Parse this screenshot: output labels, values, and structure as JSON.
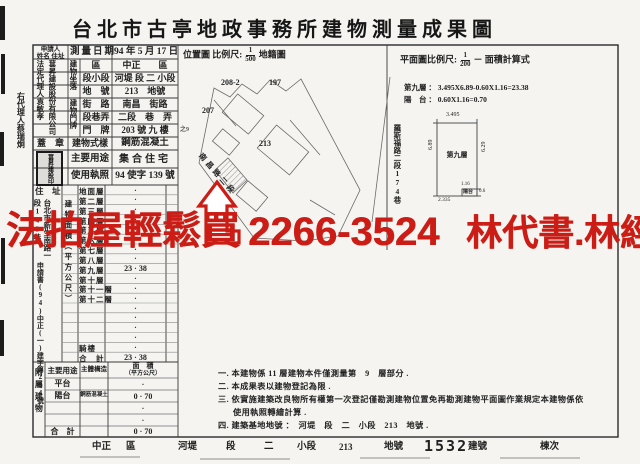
{
  "title": "台北市古亭地政事務所建物測量成果圖",
  "colors": {
    "accent_red": "#cb1d15",
    "ink": "#222222"
  },
  "watermark": {
    "left": "法拍屋輕鬆買",
    "phone": "2266-3524",
    "right": "林代書.林經理"
  },
  "header": {
    "survey_date_label": "測量日期",
    "survey_date": "94 年 5 月 17 日",
    "location_map_label": "位置圖 比例尺:",
    "location_scale_num": "1",
    "location_scale_den": "500",
    "location_map_suffix": "地籍圖",
    "plan_scale_label": "平面圖比例尺:",
    "plan_scale_num": "1",
    "plan_scale_den": "200",
    "plan_scale_suffix": "－ 面積計算式"
  },
  "applicant": {
    "header_line1": "申請人",
    "header_line2": "姓名 住址",
    "company": "葚昇建設股份有限公司",
    "legal_rep": "法定代理人袁敏孝",
    "agent_outside": "右代理人蔡瑞炯",
    "seal_label": "蓋　章",
    "seal_text": "葚昇建設印",
    "address_label": "住　址",
    "address_col1": "台北市新生南路一",
    "address_col2": "段143巷",
    "application_no": "申請書(94)中正(一)建字第234號"
  },
  "building": {
    "location_span_label": "建物坐落",
    "door_span_label": "建物門牌",
    "rows": [
      {
        "label": "區",
        "value": "中正　　區"
      },
      {
        "label": "段小段",
        "value": "河堤 段 二 小段"
      },
      {
        "label": "地　號",
        "value": "213　地號"
      },
      {
        "label": "街　路",
        "value": "南昌　街路"
      },
      {
        "label": "段巷弄",
        "value": "二段　巷　弄"
      },
      {
        "label": "門　牌",
        "value": "203 號 九 樓"
      }
    ],
    "door_extra": "之9",
    "style_label": "建物式樣",
    "style_value": "鋼筋混凝土",
    "use_label": "主要用途",
    "use_value": "集合住宅",
    "license_label": "使用執照",
    "license_value": "94 使字 139 號"
  },
  "floors": {
    "area_label": "建物面積（平方公尺）",
    "rows": [
      {
        "label": "地面層",
        "value": "·"
      },
      {
        "label": "第二層",
        "value": "·"
      },
      {
        "label": "第三層",
        "value": "·"
      },
      {
        "label": "第四層",
        "value": "·"
      },
      {
        "label": "第五層",
        "value": "·"
      },
      {
        "label": "第六層",
        "value": "·"
      },
      {
        "label": "第七層",
        "value": "·"
      },
      {
        "label": "第八層",
        "value": "·"
      },
      {
        "label": "第九層",
        "value": "23 · 38"
      },
      {
        "label": "第十層",
        "value": "·"
      },
      {
        "label": "第十一層",
        "value": "·"
      },
      {
        "label": "第十二層",
        "value": "·"
      },
      {
        "label": "",
        "value": "·"
      },
      {
        "label": "",
        "value": "·"
      },
      {
        "label": "",
        "value": "·"
      },
      {
        "label": "",
        "value": "·"
      },
      {
        "label": "騎樓",
        "value": "·"
      },
      {
        "label": "合　計",
        "value": "23 · 38"
      }
    ]
  },
  "annex": {
    "section_label": "附屬建物",
    "use_header": "主要用途",
    "structure_header": "主體構造",
    "area_header": "面　積",
    "area_header2": "（平方公尺）",
    "rows": [
      {
        "use": "平台",
        "structure": "",
        "area": "·"
      },
      {
        "use": "陽台",
        "structure": "鋼筋混凝土",
        "area": "0 · 70"
      },
      {
        "use": "",
        "structure": "",
        "area": "·"
      },
      {
        "use": "",
        "structure": "",
        "area": "·"
      }
    ],
    "total_label": "合　計",
    "total_value": "0 · 70"
  },
  "map": {
    "parcels": {
      "p1": "208-2",
      "p2": "197",
      "p3": "207",
      "p4": "213"
    },
    "street_right": "羅斯福路二段174巷",
    "street_left": "南昌路二段"
  },
  "plan": {
    "room_label": "第九層",
    "dim_top": "3.495",
    "dim_left": "6.89",
    "dim_right": "6.29",
    "dim_balcony_w": "1.16",
    "dim_balcony_h": "0.6",
    "dim_bottom": "2.335",
    "balcony_label": "陽台",
    "formula_floor": "第九層 ： 3.495X6.89-0.60X1.16=23.38",
    "formula_balcony": "陽　台 ： 0.60X1.16=0.70"
  },
  "notes": {
    "n1": "一. 本建物係 11 層建物本件僅測量第　9　層部分 .",
    "n2": "二. 本成果表以建物登記為限 .",
    "n3": "三. 依實施建築改良物所有權第一次登記僅勘測建物位置免再勘測建物平面圖作業規定本建物係依",
    "n3b": "使用執照轉繪計算 .",
    "n4": "四. 建築基地地號 ：　河堤　段　二　小段　213　地號 ."
  },
  "footer": {
    "district": "中正",
    "district_suffix": "區",
    "section": "河堤",
    "section_suffix": "段",
    "subsection": "二",
    "subsection_suffix": "小段",
    "parcel": "213",
    "parcel_suffix": "地號",
    "building_no": "1532",
    "building_no_suffix": "建號",
    "unit_suffix": "棟次"
  }
}
